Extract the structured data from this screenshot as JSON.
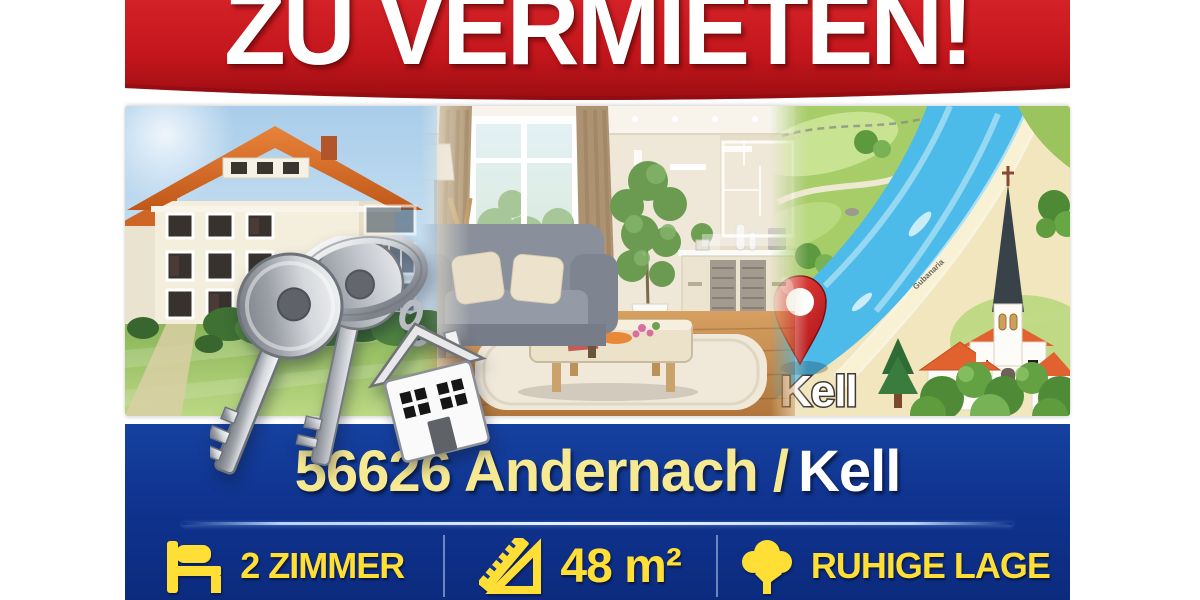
{
  "poster": {
    "title": "ZU VERMIETEN!",
    "location": {
      "primary": "56626 Andernach /",
      "secondary": "Kell"
    },
    "map": {
      "pin_label": "Kell",
      "road_label": "Gubanaria"
    },
    "features": [
      {
        "icon": "bed-icon",
        "label": "2 ZIMMER"
      },
      {
        "icon": "area-ruler-icon",
        "label": "48 m²"
      },
      {
        "icon": "tree-icon",
        "label": "RUHIGE LAGE"
      }
    ],
    "colors": {
      "banner_red": "#c3161c",
      "banner_blue": "#0f338f",
      "accent_yellow": "#ffdf35",
      "pale_yellow": "#f6e992",
      "map_river_blue": "#4cbbe9",
      "pin_red": "#c41318"
    }
  }
}
